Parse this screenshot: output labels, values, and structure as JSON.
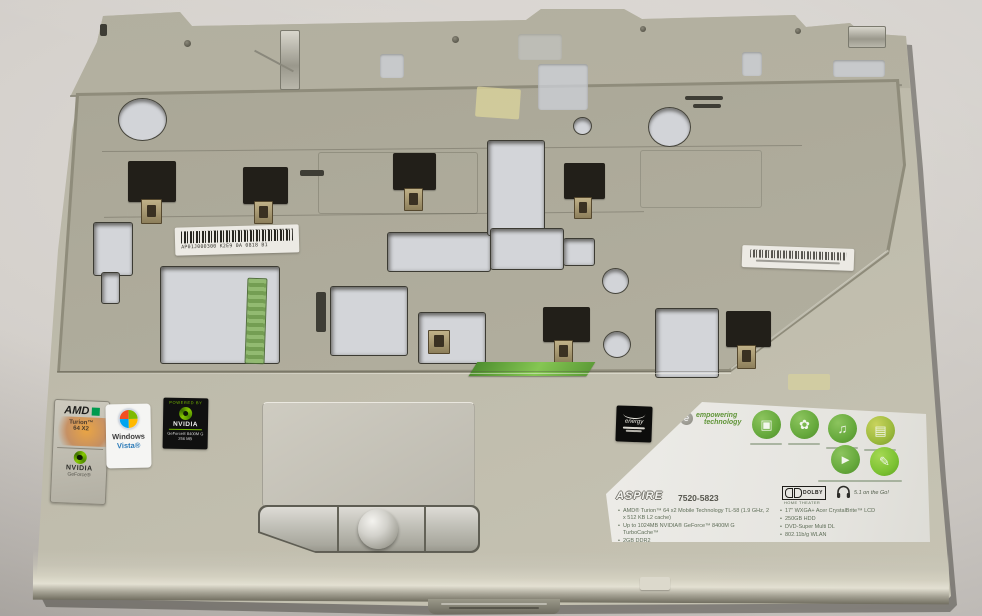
{
  "colors": {
    "chassis_beige": "#b7b4a4",
    "backdrop_gray": "#d3cfca",
    "nvidia_green": "#76b900",
    "acer_label_green": "#6fae3e",
    "label_background": "#e9e9e5"
  },
  "stickers": {
    "amd_combo": {
      "brand": "AMD",
      "cpu_line1": "Turion™",
      "cpu_line2": "64 X2",
      "partner_brand": "NVIDIA",
      "partner_line": "GeForce®"
    },
    "windows_vista": {
      "line1": "Windows",
      "line2": "Vista®"
    },
    "nvidia_gpu": {
      "header": "POWERED BY",
      "brand": "NVIDIA",
      "model": "GeForce® 8400M G",
      "memory": "256 MB"
    }
  },
  "barcode_labels": {
    "center": "AP01J000300 K2E9 0A 0818 B1"
  },
  "energy_star": {
    "word": "energy"
  },
  "spec_label": {
    "logo_word1": "empowering",
    "logo_word2": "technology",
    "series": "ASPIRE",
    "model": "7520-5823",
    "dolby_dd": "D",
    "dolby_word": "DOLBY",
    "dolby_sub": "HOME THEATER",
    "audio_tag": "5.1 on the Go!",
    "feature_icons": [
      {
        "name": "display-icon",
        "glyph": "▣"
      },
      {
        "name": "eco-icon",
        "glyph": "✿"
      },
      {
        "name": "audio-icon",
        "glyph": "♫"
      },
      {
        "name": "battery-icon",
        "glyph": "▤"
      },
      {
        "name": "media-icon",
        "glyph": "►"
      },
      {
        "name": "pen-icon",
        "glyph": "✎"
      }
    ],
    "specs_left": [
      "AMD® Turion™ 64 x2 Mobile Technology TL-58 (1.9 GHz, 2 x 512 KB L2 cache)",
      "Up to 1024MB NVIDIA® GeForce™ 8400M G TurboCache™",
      "2GB DDR2"
    ],
    "specs_right": [
      "17\" WXGA+ Acer CrystalBrite™ LCD",
      "250GB HDD",
      "DVD-Super Multi DL",
      "802.11b/g WLAN"
    ]
  }
}
